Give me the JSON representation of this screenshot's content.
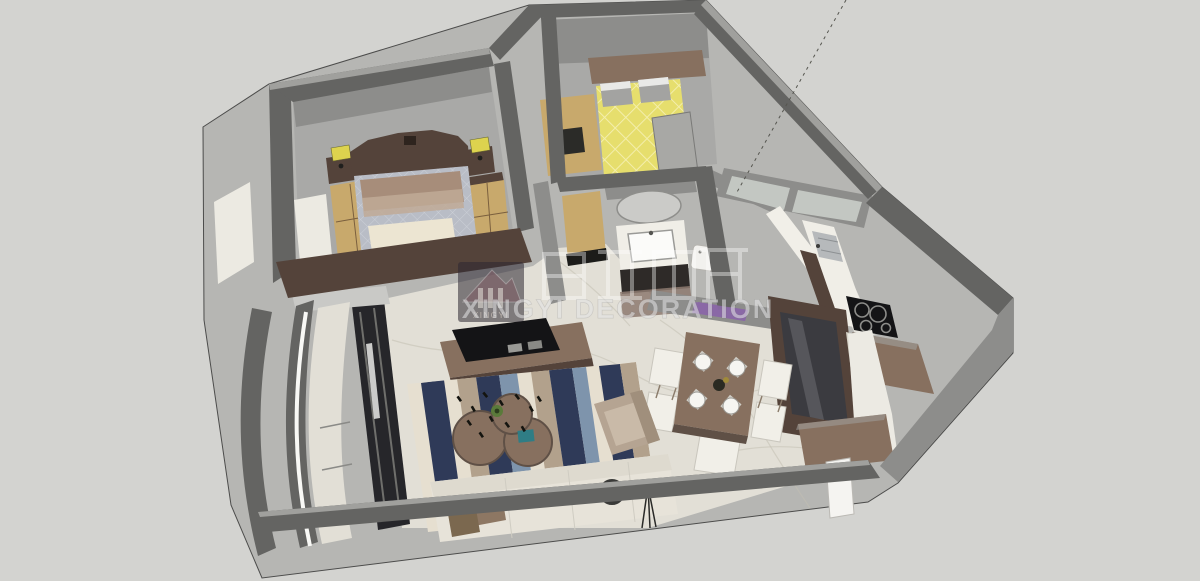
{
  "watermark": {
    "logo_text": "XINGYI",
    "brand_text": "XINGYI DECORATION",
    "cn_characters": "星艺装饰"
  },
  "palette": {
    "bg": "#d3d3d0",
    "edge_line": "#4c4c4b",
    "wall_light": "#b6b6b3",
    "wall_dark": "#646462",
    "wall_mid": "#8d8d8b",
    "wall_top": "#a0a09d",
    "floor_gray": "#a9a9a7",
    "floor_marble": "#e2dfd6",
    "marble_vein": "#c2bfb2",
    "wood_light": "#c8a96c",
    "wood_mid": "#87705f",
    "wood_dark": "#54433a",
    "bed_quilt": "#b9bdc6",
    "quilt_line": "#ccd0d7",
    "pillow_tan": "#a78d7a",
    "throw_cream": "#ece5d2",
    "bed_yellow": "#e6de6d",
    "bed_yellow_line": "#f3eeac",
    "pillow_gray": "#a3a3a1",
    "sofa_cream": "#e7e3d9",
    "chair_white": "#f1efe8",
    "chair_edge": "#c9c6bd",
    "armchair_tan": "#b5a492",
    "tv_black": "#141416",
    "counter_white": "#f0eee7",
    "paper_white": "#eceae2",
    "steel": "#b6b9bb",
    "purple_accent": "#8a68a6",
    "lamp_yellow": "#ddd34e",
    "window_dark": "#26262a",
    "teal_accent": "#2f7d85",
    "rug_navy": "#2f3a58",
    "rug_blue": "#7e94ac",
    "rug_tan": "#b2a18c",
    "rug_cream": "#e6dfd0",
    "watermark_text": "rgba(228,228,230,0.55)",
    "logo_bg": "rgba(44,38,50,0.55)"
  }
}
